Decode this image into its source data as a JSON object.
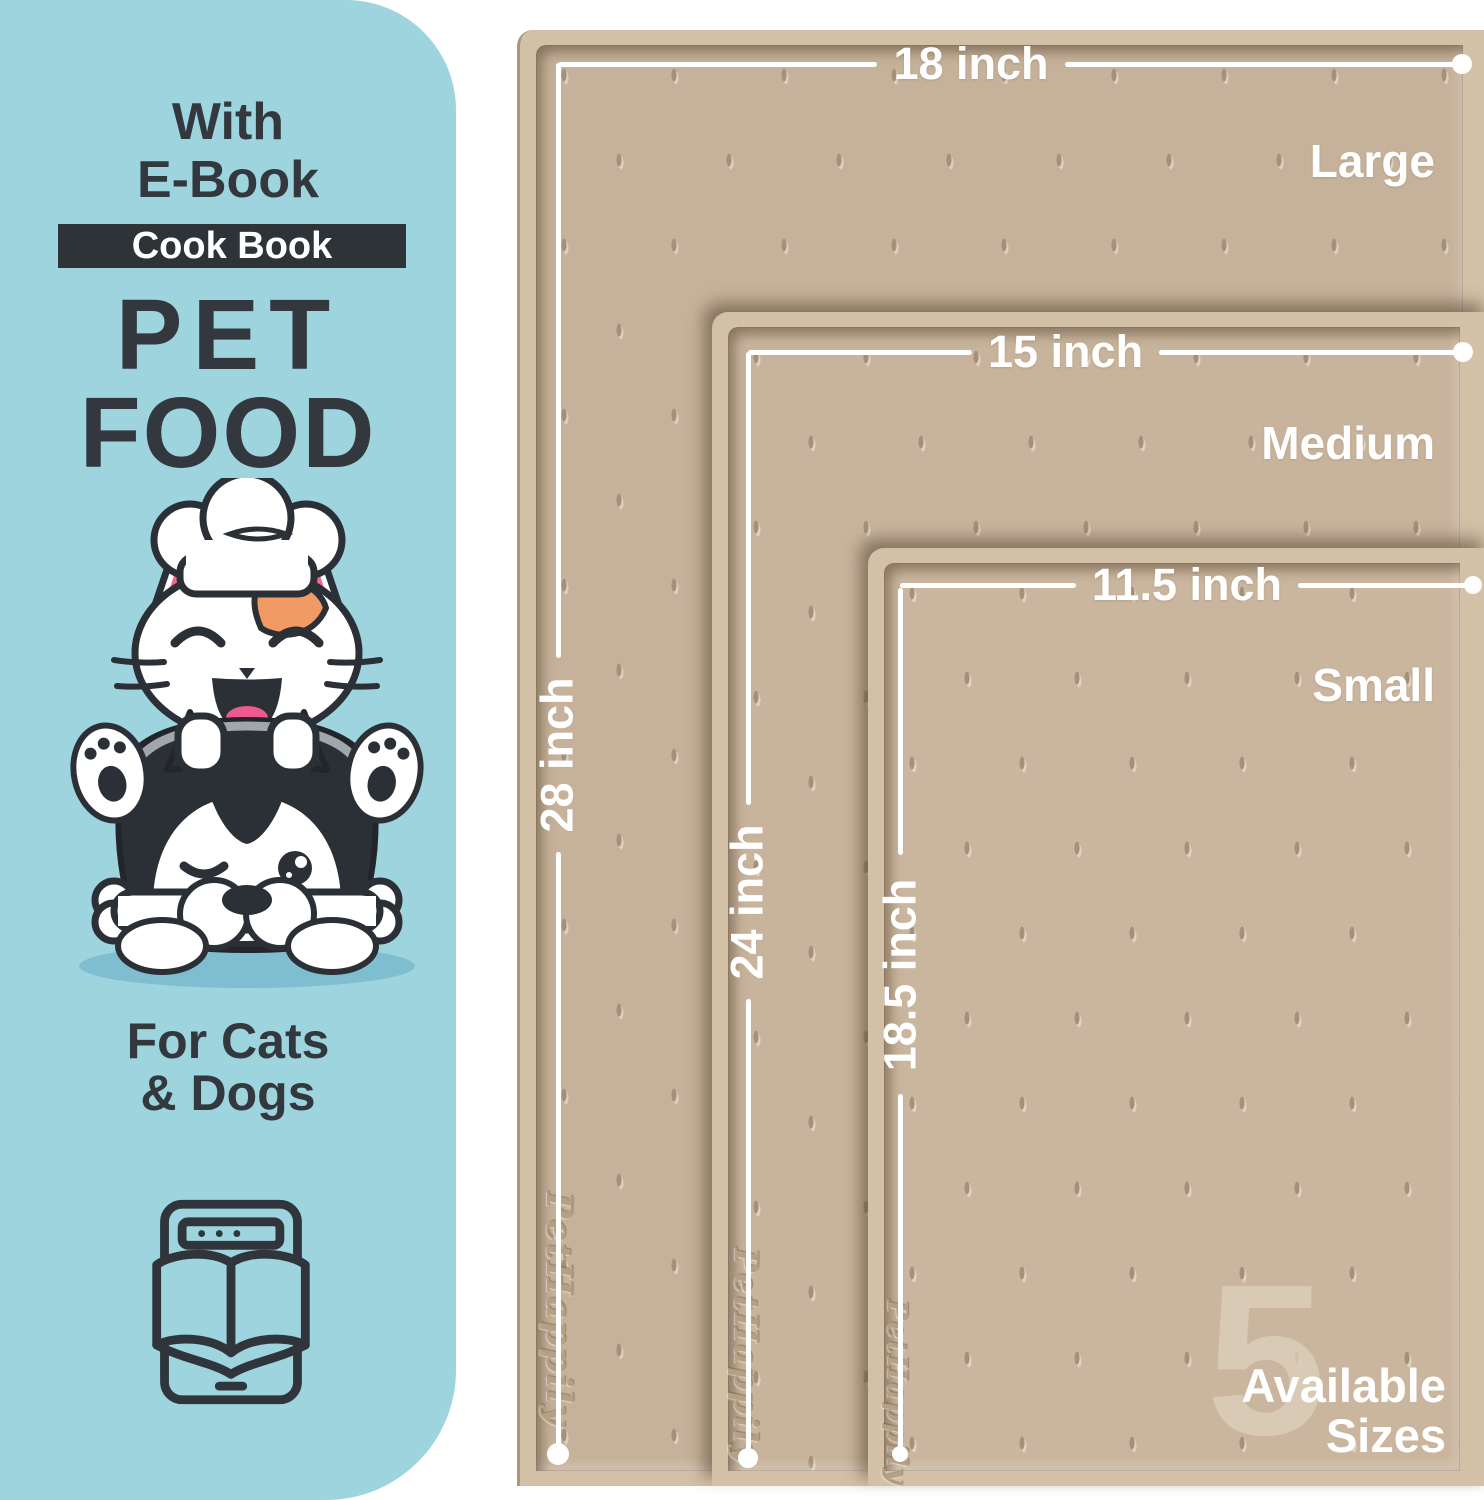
{
  "panel": {
    "bg_color": "#9ed4de",
    "text_color": "#33383e",
    "eyebrow_line1": "With",
    "eyebrow_line2": "E-Book",
    "badge_label": "Cook Book",
    "badge_bg": "#2e3338",
    "title_line1": "PET",
    "title_line2": "FOOD",
    "audience_line1": "For Cats",
    "audience_line2": "& Dogs",
    "illustration": "cat-chef-and-husky-with-bone",
    "icon": "ebook-tablet-open-book-icon"
  },
  "mats": [
    {
      "size_label": "Large",
      "width_label": "18 inch",
      "height_label": "28 inch",
      "embossed_logo": "PetHappily",
      "surface_color": "#c6b29a"
    },
    {
      "size_label": "Medium",
      "width_label": "15 inch",
      "height_label": "24 inch",
      "embossed_logo": "PetHappily",
      "surface_color": "#c8b49c"
    },
    {
      "size_label": "Small",
      "width_label": "11.5 inch",
      "height_label": "18.5 inch",
      "embossed_logo": "PetHappily",
      "surface_color": "#cab69e"
    }
  ],
  "sizes_badge": {
    "count": "5",
    "line1": "Available",
    "line2": "Sizes"
  },
  "colors": {
    "mat_rim": "#d2c0a7",
    "dimension_line": "#ffffff",
    "rim_shadow": "rgba(80,62,44,0.55)"
  }
}
